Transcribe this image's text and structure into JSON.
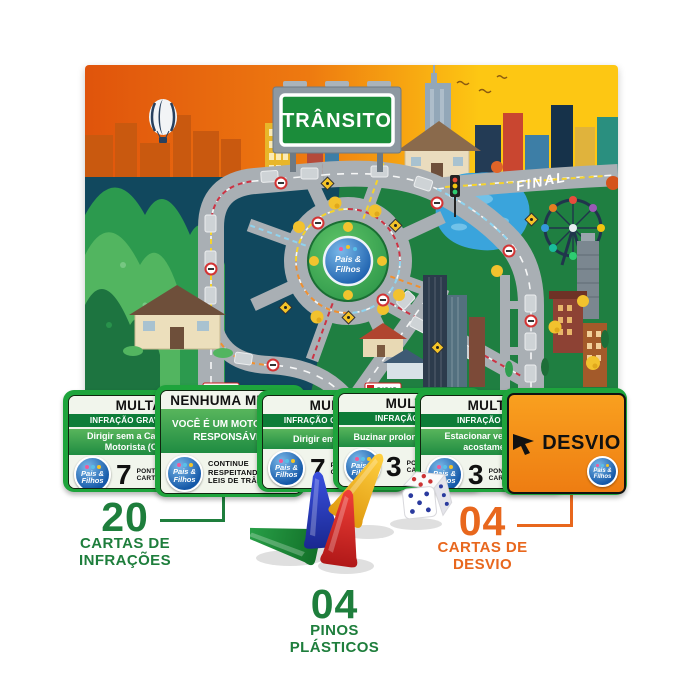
{
  "board": {
    "title": "TRÂNSITO",
    "final_label": "FINAL",
    "radar_label": "RADAR",
    "logo_line1": "Pais &",
    "logo_line2": "Filhos"
  },
  "logo": {
    "line1": "Pais &",
    "line2": "Filhos"
  },
  "cards": [
    {
      "header": "MULTA",
      "severity": "INFRAÇÃO GRAVÍSSIMA",
      "infraction": "Dirigir sem a Carteira de Motorista (CNH)",
      "points": "7",
      "points_label_line1": "PONTOS NA",
      "points_label_line2": "CARTEIRA"
    },
    {
      "header": "NENHUMA MULTA",
      "body_line1": "VOCÊ É UM MOTORISTA",
      "body_line2": "RESPONSÁVEL",
      "footer_line1": "CONTINUE",
      "footer_line2": "RESPEITANDO",
      "footer_line3": "LEIS DE TRÂNSITO"
    },
    {
      "header": "MULTA",
      "severity": "INFRAÇÃO GRAVÍSSIMA",
      "infraction": "Dirigir embriagado",
      "points": "7",
      "points_label_line1": "PONTOS NA",
      "points_label_line2": "CARTEIRA"
    },
    {
      "header": "MULTA",
      "severity": "INFRAÇÃO LEVE",
      "infraction": "Buzinar prolongadamente",
      "points": "3",
      "points_label_line1": "PONTOS NA",
      "points_label_line2": "CARTEIRA"
    },
    {
      "header": "MULTA",
      "severity": "INFRAÇÃO LEVE",
      "infraction": "Estacionar veículo no acostamento",
      "points": "3",
      "points_label_line1": "PONTOS NA",
      "points_label_line2": "CARTEIRA"
    },
    {
      "header": "DESVIO"
    }
  ],
  "annotations": {
    "infracoes": {
      "number": "20",
      "line1": "CARTAS DE",
      "line2": "INFRAÇÕES"
    },
    "pinos": {
      "number": "04",
      "line1": "PINOS",
      "line2": "PLÁSTICOS"
    },
    "desvio": {
      "number": "04",
      "line1": "CARTAS DE",
      "line2": "DESVIO"
    }
  },
  "pieces": {
    "pins": [
      {
        "name": "green-pin",
        "hex": "#1d9440"
      },
      {
        "name": "blue-pin",
        "hex": "#2436c8"
      },
      {
        "name": "red-pin",
        "hex": "#d42424"
      },
      {
        "name": "yellow-pin",
        "hex": "#f2b814"
      }
    ],
    "dice": {
      "top_pips": 4,
      "front_pips": 5,
      "side_pips": 3,
      "top_pip_color": "#cc3333",
      "front_pip_color": "#2a3a9e"
    }
  },
  "colors": {
    "card-green": "#1ea43c",
    "card-green-dark": "#0d7c38",
    "annotation-green": "#1e7e3c",
    "annotation-orange": "#e8671d",
    "desvio-orange": "#f4881c",
    "sky-orange": "#ec6c0e",
    "sky-yellow": "#fdc713",
    "ground-teal": "#11485e",
    "ground-green": "#1f7f41",
    "road-gray": "#a9afb4",
    "sign-green": "#1b8c3a",
    "lake-blue": "#3aa4dc"
  }
}
